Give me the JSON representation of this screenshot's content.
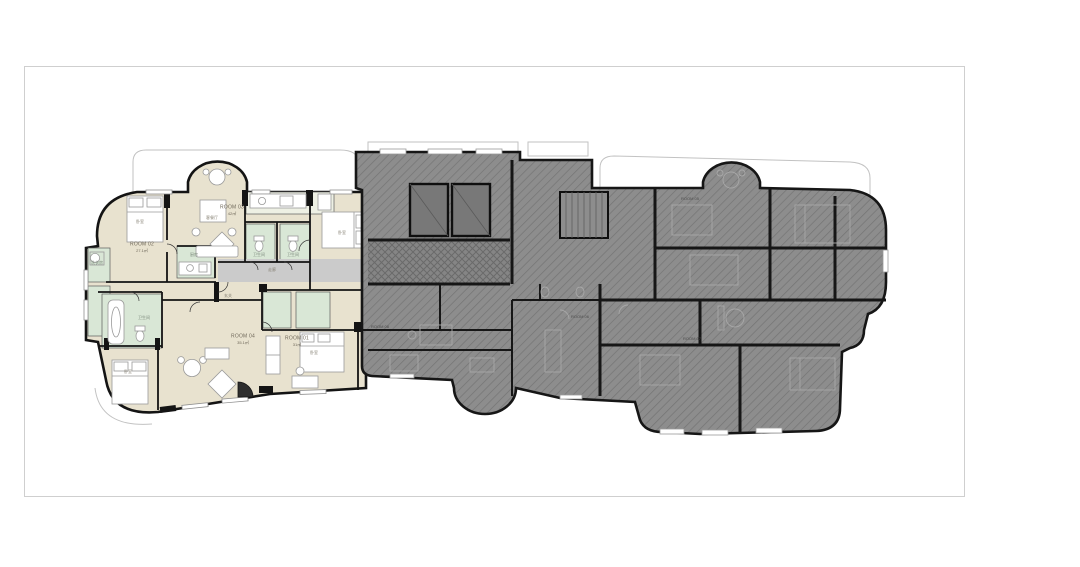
{
  "page": {
    "background": "#ffffff",
    "frame_border_color": "#cfcfcf",
    "description_type": "architectural-floor-plan"
  },
  "colors": {
    "wall_black": "#141414",
    "unit_fill_beige": "#e8e2cf",
    "wet_room_green": "#d9e7d6",
    "corridor_gray": "#cbcbcb",
    "dimmed_fill": "#8d8d8d",
    "dimmed_hatch": "#747474",
    "terrace_outline": "#c2c2c2",
    "furniture_stroke": "#9a9a9a"
  },
  "highlighted_unit": {
    "rooms": [
      {
        "label": "ROOM 01",
        "area": "31㎡"
      },
      {
        "label": "ROOM 02",
        "area": "27.1㎡"
      },
      {
        "label": "ROOM 03",
        "area": "42㎡"
      },
      {
        "label": "ROOM 04",
        "area": "35.1㎡"
      }
    ]
  },
  "dimmed_wing": {
    "rooms": [
      {
        "label": "ROOM 05"
      },
      {
        "label": "ROOM 06"
      },
      {
        "label": "ROOM 07"
      },
      {
        "label": "ROOM 08"
      }
    ]
  },
  "labels": {
    "room01": "ROOM 01",
    "room01_area": "31㎡",
    "room02": "ROOM 02",
    "room02_area": "27.1㎡",
    "room03": "ROOM 03",
    "room03_area": "42㎡",
    "room04": "ROOM 04",
    "room04_area": "35.1㎡",
    "room05": "ROOM 05",
    "room06": "ROOM 06",
    "room07": "ROOM 07",
    "room08": "ROOM 08",
    "bedroom": "卧室",
    "living_dining": "客餐厅",
    "kitchen": "厨房",
    "bathroom": "卫生间",
    "corridor": "走廊",
    "entry": "玄关",
    "laundry": "洗衣房"
  }
}
